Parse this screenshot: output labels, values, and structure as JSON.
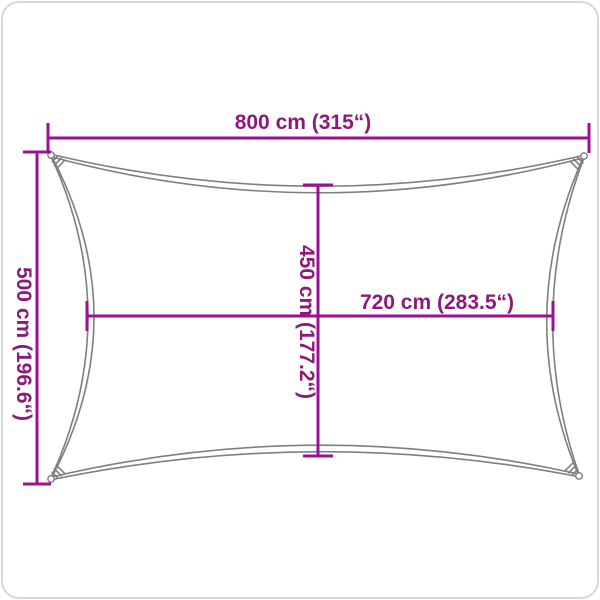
{
  "diagram": {
    "kind": "shade-sail-dimension-diagram",
    "labels": {
      "width_top": "800 cm (315“)",
      "height_left": "500 cm (196.6“)",
      "inner_height": "450 cm (177.2“)",
      "inner_width": "720 cm (283.5“)"
    },
    "dimensions_cm": {
      "outer_width": 800,
      "outer_height": 500,
      "inner_height": 450,
      "inner_width": 720
    },
    "colors": {
      "dimension-line": "#9c1095",
      "dimension-text": "#8c1a7b",
      "sail-outline": "#7f7f7f",
      "background": "#ffffff",
      "frame": "#d9d9d9"
    }
  }
}
